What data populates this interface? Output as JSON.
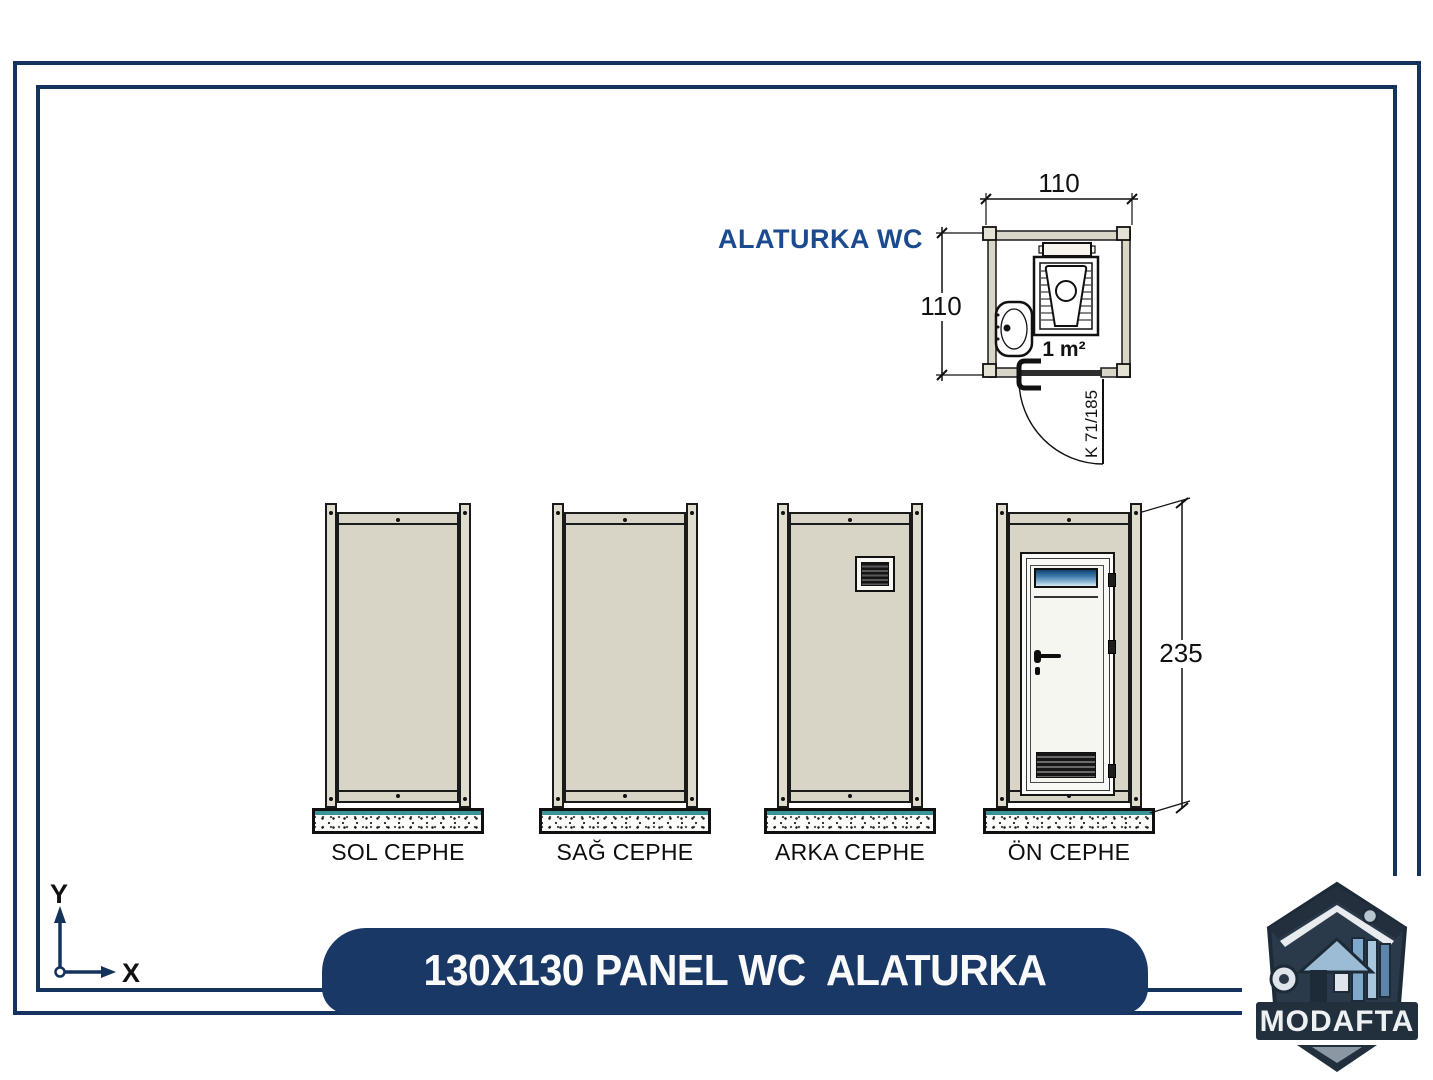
{
  "title_bar": {
    "text": "130X130 PANEL WC  ALATURKA"
  },
  "plan": {
    "heading": "ALATURKA WC",
    "dim_width": "110",
    "dim_height": "110",
    "area": "1 m²",
    "door_code": "K 71/185"
  },
  "elevations": {
    "height_dim": "235",
    "views": [
      {
        "label": "SOL CEPHE"
      },
      {
        "label": "SAĞ CEPHE"
      },
      {
        "label": "ARKA CEPHE"
      },
      {
        "label": "ÖN CEPHE"
      }
    ]
  },
  "axis": {
    "x": "X",
    "y": "Y"
  },
  "logo": {
    "name": "MODAFTA"
  },
  "colors": {
    "navy_border": "#14335e",
    "title_bar_navy": "#1a3866",
    "heading_blue": "#1b4a8e",
    "panel_beige": "#d8d4c6",
    "post_beige": "#e0dcce",
    "concrete_teal": "#3b9297",
    "door_glass_blue": "#3e7cab",
    "line_black": "#141414"
  }
}
